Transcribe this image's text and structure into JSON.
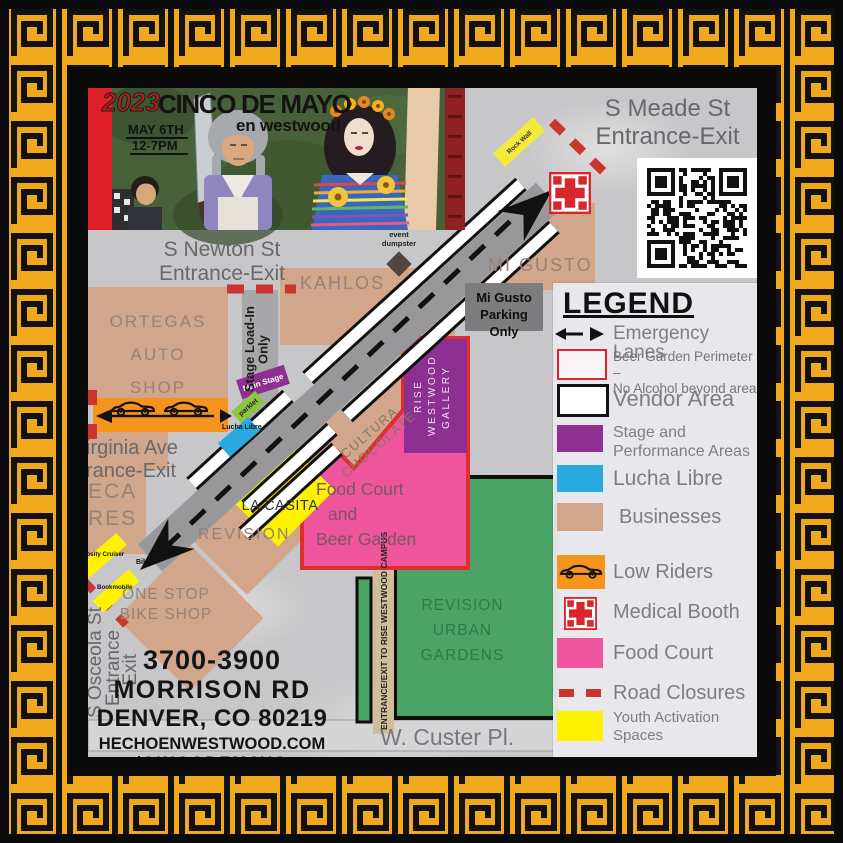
{
  "banner": {
    "year": "2023",
    "title": "CINCO DE MAYO",
    "subtitle": "en westwood",
    "date": "MAY 6TH",
    "time": "12-7PM"
  },
  "entrances": {
    "meade": {
      "line1": "S Meade St",
      "line2": "Entrance-Exit"
    },
    "newton": {
      "line1": "S Newton St",
      "line2": "Entrance-Exit"
    },
    "virginia": {
      "line1": "irginia Ave",
      "line2": "rance-Exit"
    },
    "osceola": {
      "line1": "S Osceola St",
      "line2": "Entrance",
      "line3": "-Exit"
    }
  },
  "places": {
    "ortegas": {
      "l1": "ORTEGAS",
      "l2": "AUTO",
      "l3": "SHOP"
    },
    "kahlos": "KAHLOS",
    "mi_gusto": "MI GUSTO",
    "mi_gusto_parking": {
      "l1": "Mi Gusto",
      "l2": "Parking Only"
    },
    "azteca": {
      "l1": "ECA",
      "l2": "RES"
    },
    "revision": "REVISION",
    "la_casita": "LA CASITA",
    "cultura": {
      "l1": "CULTURA",
      "l2": "CHOCOLATE"
    },
    "rise": {
      "l1": "RISE",
      "l2": "WESTWOOD",
      "l3": "GALLERY"
    },
    "food_court": {
      "l1": "Food Court",
      "l2": "and",
      "l3": "Beer Garden"
    },
    "one_stop": {
      "l1": "ONE STOP",
      "l2": "BIKE SHOP"
    },
    "gardens": {
      "l1": "REVISION",
      "l2": "URBAN",
      "l3": "GARDENS"
    },
    "custer": "W. Custer Pl.",
    "campus_path": "ENTRANCE/EXIT TO RISE WESTWOOD CAMPUS",
    "stage_loadin": {
      "l1": "Stage Load-In",
      "l2": "Only"
    },
    "main_stage": "Main Stage",
    "parklet": "parklet",
    "lucha_libre": "Lucha Libre",
    "rock_wall": "Rock Wall",
    "event_dumpster": {
      "l1": "event",
      "l2": "dumpster"
    },
    "curiosity": "Curiosity Cruiser",
    "bookmobile": "Bookmobile",
    "bikes": "Bikes"
  },
  "address": {
    "l1": "3700-3900",
    "l2": "MORRISON RD",
    "l3": "DENVER, CO 80219",
    "web1": "HECHOENWESTWOOD.COM",
    "web2": "/CINCODEMAYO"
  },
  "legend": {
    "title": "LEGEND",
    "items": [
      {
        "label": "Emergency Lanes",
        "swatch": "emergency-arrows"
      },
      {
        "line1": "Beer Garden Perimeter –",
        "line2": "No Alcohol beyond area",
        "swatch": "red-outline"
      },
      {
        "label": "Vendor Area",
        "swatch": "black-outline"
      },
      {
        "line1": "Stage and",
        "line2": "Performance Areas",
        "swatch": "purple"
      },
      {
        "label": "Lucha Libre",
        "swatch": "blue"
      },
      {
        "label": "Businesses",
        "swatch": "tan"
      },
      {
        "label": "Low Riders",
        "swatch": "orange-lowrider"
      },
      {
        "label": "Medical Booth",
        "swatch": "medical-cross"
      },
      {
        "label": "Food Court",
        "swatch": "pink"
      },
      {
        "label": "Road Closures",
        "swatch": "red-dashes"
      },
      {
        "line1": "Youth Activation",
        "line2": "Spaces",
        "swatch": "yellow"
      }
    ]
  },
  "colors": {
    "businesses": "#D1A68A",
    "stage": "#8D3091",
    "lucha_libre": "#2AA9E0",
    "low_riders": "#F7941E",
    "food_court": "#EF559C",
    "beer_perimeter": "#E02D2D",
    "road_closures": "#C9362F",
    "youth": "#FFF200",
    "gardens": "#4BA365",
    "border_gold": "#F0A81C"
  }
}
